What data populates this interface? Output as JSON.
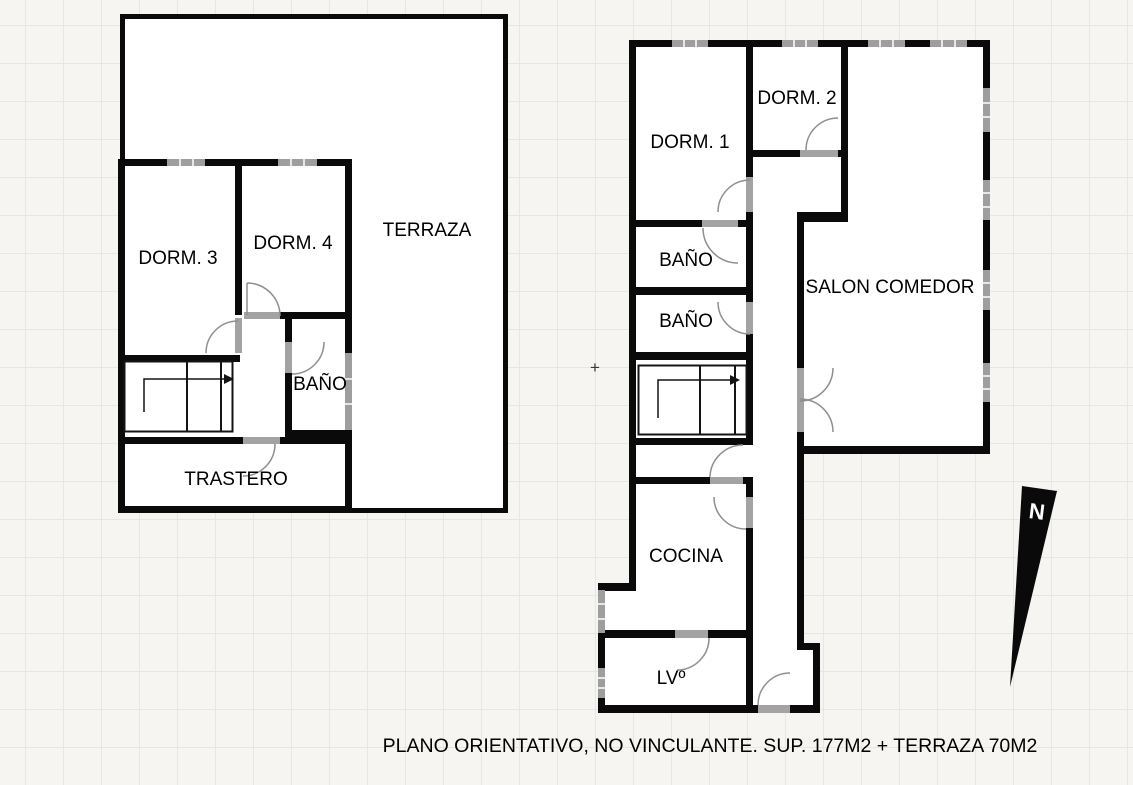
{
  "caption": "PLANO ORIENTATIVO, NO VINCULANTE. SUP. 177M2 + TERRAZA 70M2",
  "compass": {
    "north_label": "N"
  },
  "divider_marker": "+",
  "plans": {
    "left": {
      "rooms": {
        "dorm3": "DORM. 3",
        "dorm4": "DORM. 4",
        "terraza": "TERRAZA",
        "bano": "BAÑO",
        "trastero": "TRASTERO"
      }
    },
    "right": {
      "rooms": {
        "dorm1": "DORM. 1",
        "dorm2": "DORM. 2",
        "bano_1": "BAÑO",
        "bano_2": "BAÑO",
        "salon_comedor": "SALON COMEDOR",
        "cocina": "COCINA",
        "lavadero": "LVº"
      }
    }
  },
  "colors": {
    "background": "#f6f5f2",
    "grid_line": "#e8e6e2",
    "wall": "#0a0a0a",
    "window": "#9e9e9e",
    "door": "#8f8f8f",
    "text": "#000000"
  }
}
